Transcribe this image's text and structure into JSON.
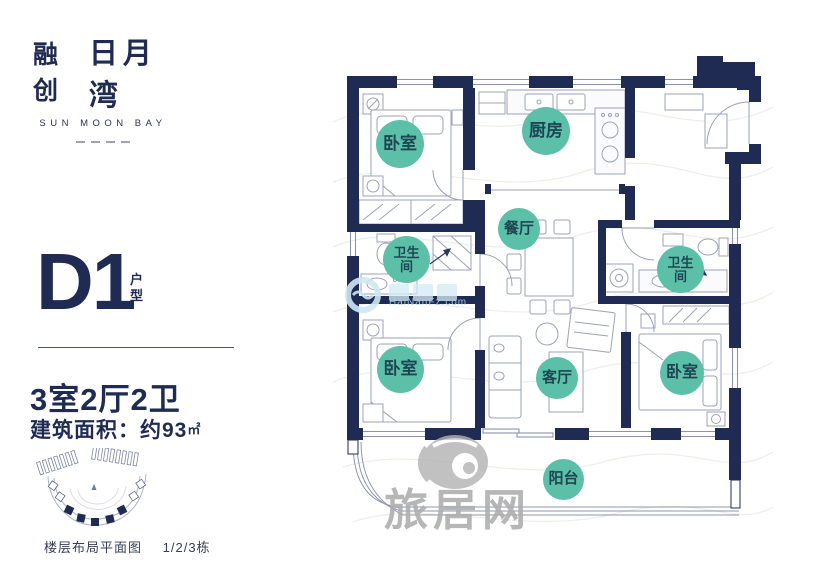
{
  "brand": {
    "cn_bold": "融创",
    "cn_name": "日月湾",
    "en": "SUN MOON BAY"
  },
  "unit": {
    "code": "D1",
    "suffix": "户型"
  },
  "specs": {
    "layout": "3室2厅2卫",
    "area": "建筑面积：约93",
    "area_unit": "㎡"
  },
  "site": {
    "caption": "楼层布局平面图",
    "buildings": "1/2/3栋"
  },
  "floorplan": {
    "rooms": [
      {
        "id": "bedroom-top-left",
        "label": "卧室"
      },
      {
        "id": "kitchen",
        "label": "厨房"
      },
      {
        "id": "dining-room",
        "label": "餐厅"
      },
      {
        "id": "bathroom-left",
        "label": "卫生间"
      },
      {
        "id": "bathroom-right",
        "label": "卫生间"
      },
      {
        "id": "bedroom-bottom-left",
        "label": "卧室"
      },
      {
        "id": "living-room",
        "label": "客厅"
      },
      {
        "id": "bedroom-bottom-right",
        "label": "卧室"
      },
      {
        "id": "balcony",
        "label": "阳台"
      }
    ]
  },
  "watermarks": {
    "portal": "旅居网",
    "site_url": "HaiNanFz.com"
  },
  "colors": {
    "navy": "#1f2b52",
    "teal": "#5cc0a9",
    "teal_text": "#1d4652",
    "watermark_gray": "#adadad"
  }
}
